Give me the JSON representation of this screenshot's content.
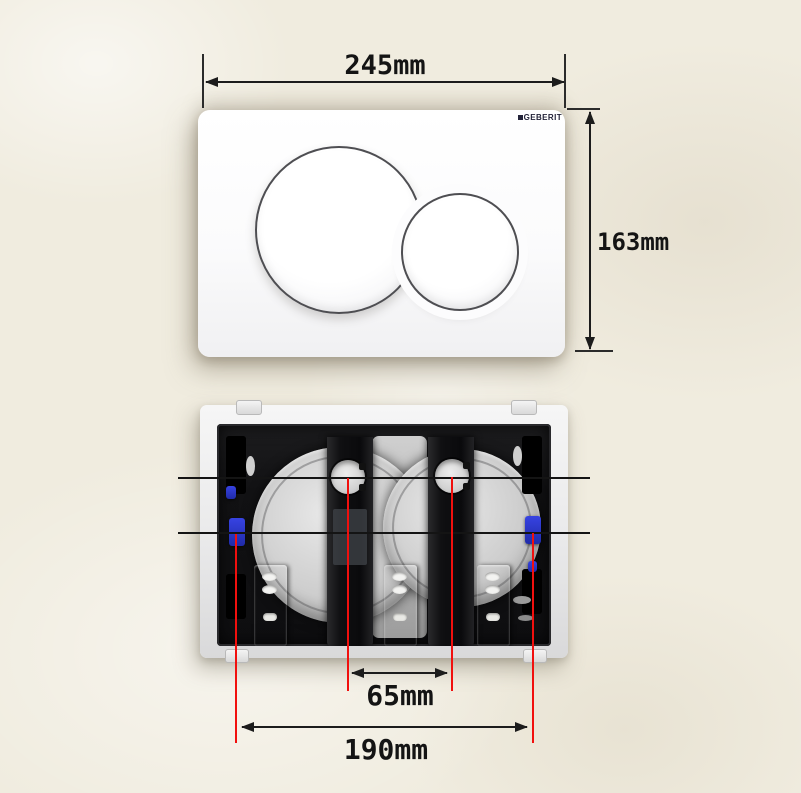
{
  "front_view": {
    "brand_logo": "GEBERIT",
    "width_dimension_label": "245mm",
    "height_dimension_label": "163mm"
  },
  "back_view": {
    "hole_spacing_label": "65mm",
    "mount_spacing_label": "190mm"
  },
  "colors": {
    "background": "#f0ecdf",
    "annotation_red": "#f1100e",
    "annotation_black": "#1a1a1a",
    "clip_blue": "#2a35cf",
    "spring_clip_bronze": "#9c8257",
    "plate_white": "#fcfcfd"
  }
}
